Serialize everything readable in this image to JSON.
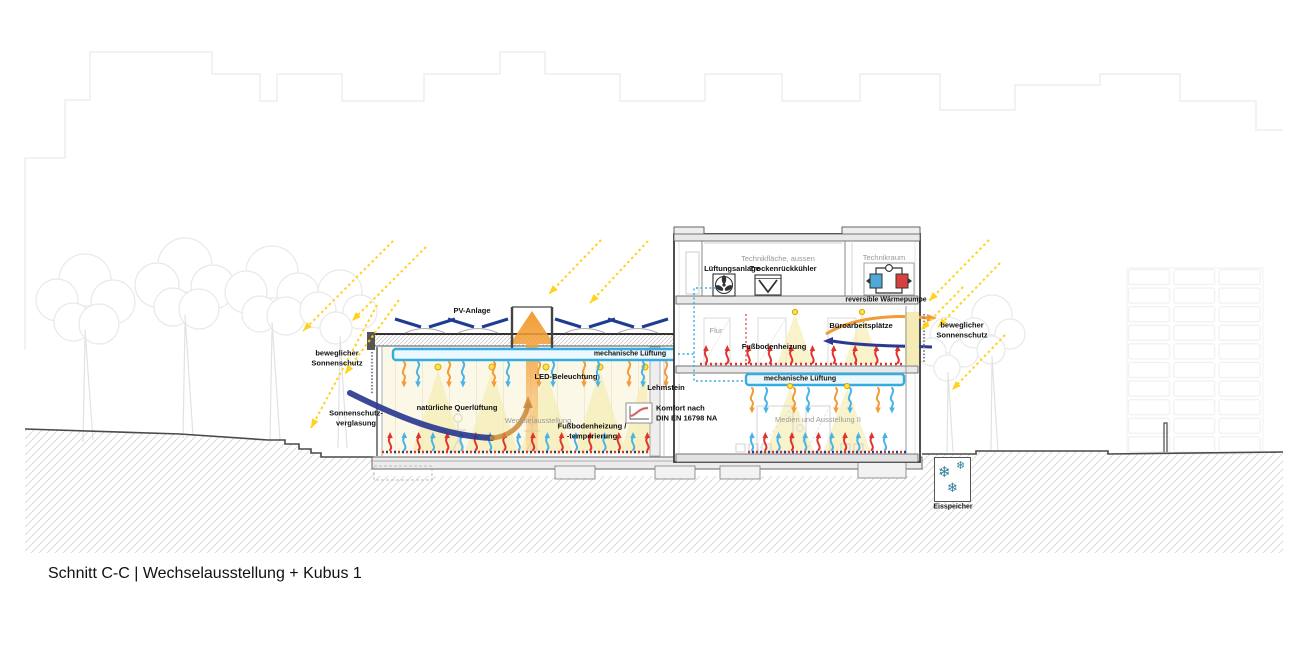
{
  "title": "Schnitt C-C | Wechselausstellung + Kubus 1",
  "annotations": {
    "pv": "PV-Anlage",
    "mech_vent_hall": "mechanische Lüftung",
    "led": "LED-Beleuchtung",
    "movable_shading_left_1": "beweglicher",
    "movable_shading_left_2": "Sonnenschutz",
    "sun_glazing_1": "Sonnenschutz-",
    "sun_glazing_2": "verglasung",
    "natural_vent": "natürliche Querlüftung",
    "hall_room": "Wechselausstellung",
    "floor_heating_hall_1": "Fußbodenheizung /",
    "floor_heating_hall_2": "-temperierung",
    "clay_brick": "Lehmstein",
    "comfort_1": "Komfort nach",
    "comfort_2": "DIN EN 16798 NA",
    "tech_area_outside": "Technikfläche, aussen",
    "ahu": "Lüftungsanlage",
    "dry_cooler": "Trockenrückkühler",
    "tech_room": "Technikraum",
    "heat_pump": "reversible Wärmepumpe",
    "corridor": "Flur",
    "floor_heating_kubus": "Fußbodenheizung",
    "office_workplaces": "Büroarbeitsplätze",
    "mech_vent_kubus": "mechanische Lüftung",
    "media_room": "Medien und Ausstellung II",
    "movable_shading_right_1": "beweglicher",
    "movable_shading_right_2": "Sonnenschutz",
    "ice_storage": "Eisspeicher"
  },
  "icons": {
    "snowflake": "❄"
  },
  "colors": {
    "sun_ray_yellow": "#FFD21E",
    "pv_panel_blue": "#1F3C93",
    "vent_duct_blue": "#35ACE0",
    "supply_air_orange": "#F29B38",
    "cool_air_blue": "#4AB4E6",
    "heating_red": "#E0342F",
    "night_air_navy": "#2B3A90",
    "light_cone_yellow": "#F6EEB6",
    "interior_wash_yellow": "#FBF8E8",
    "ice_teal": "#2E7C95"
  }
}
